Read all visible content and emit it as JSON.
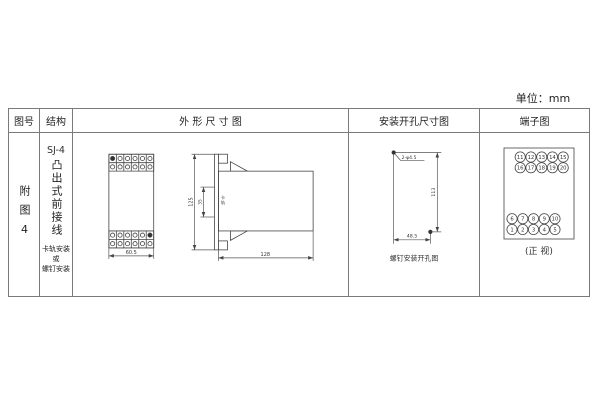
{
  "unit_label": "单位：mm",
  "colors": {
    "border": "#7a7a7a",
    "line": "#444444",
    "text": "#2e2e2e"
  },
  "header": {
    "col_figure": "图号",
    "col_structure": "结构",
    "col_outline": "外 形 尺 寸 图",
    "col_mounting": "安装开孔尺寸图",
    "col_terminal": "端子图"
  },
  "figure": {
    "label": "附图4"
  },
  "structure": {
    "model": "SJ-4",
    "type": "凸出式前接线",
    "mounting_lines": [
      "卡轨安装",
      "或",
      "螺钉安装"
    ]
  },
  "outline": {
    "front_width": "60.5",
    "height": "125",
    "rail_gap": "35",
    "rail_label": "卡轨",
    "depth": "128"
  },
  "mounting": {
    "holes": "2-φ4.5",
    "v_dist": "113",
    "h_dist": "48.5",
    "caption": "螺钉安装开孔图"
  },
  "terminal_diagram": {
    "rows_top": [
      [
        "11",
        "12",
        "13",
        "14",
        "15"
      ],
      [
        "16",
        "17",
        "18",
        "19",
        "20"
      ]
    ],
    "rows_bottom": [
      [
        "6",
        "7",
        "8",
        "9",
        "10"
      ],
      [
        "1",
        "2",
        "3",
        "4",
        "5"
      ]
    ],
    "caption": "(正 视)"
  }
}
